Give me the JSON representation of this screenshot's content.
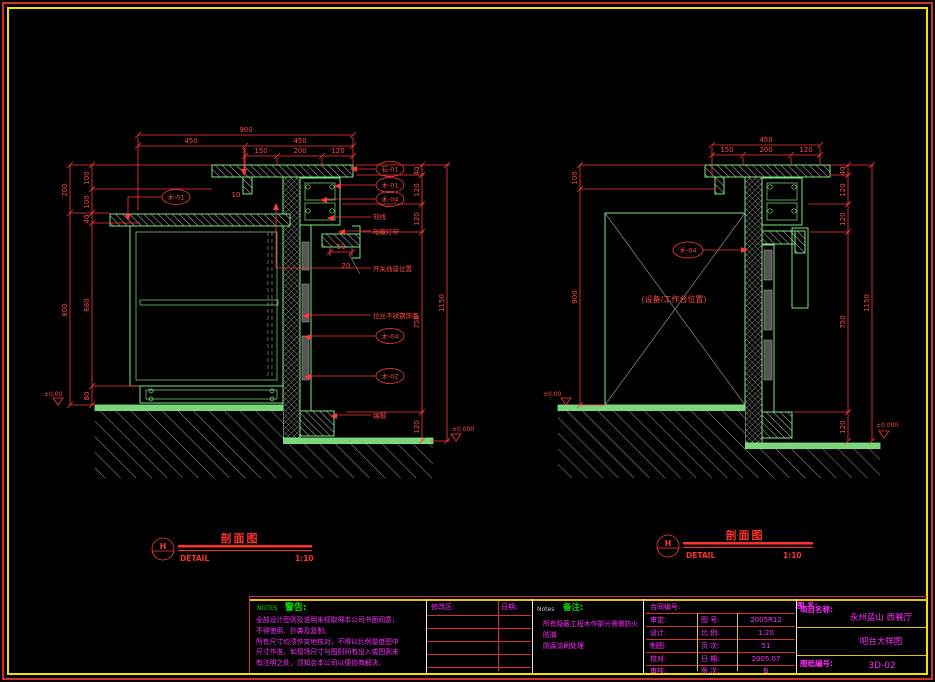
{
  "colors": {
    "line_green": "#7de57d",
    "dim_red": "#ff3838",
    "magenta": "#ff2bff",
    "note_green": "#00e000",
    "frame_yellow": "#f5e100",
    "frame_red": "#d03030"
  },
  "left_view": {
    "top_dims": {
      "total": "900",
      "seg_left": "450",
      "seg_right": "450",
      "s1": "150",
      "s2": "200",
      "s3": "120",
      "drop": "10"
    },
    "left_dims": {
      "a": "200",
      "b": "100",
      "c": "100",
      "d": "40",
      "e": "800",
      "f": "680",
      "g": "80",
      "level": "±0.00"
    },
    "right_dims": {
      "a": "40",
      "b": "120",
      "c": "120",
      "d": "750",
      "e": "120",
      "total": "1150",
      "level": "±0.000"
    },
    "misc_dims": {
      "a": "50",
      "b": "20"
    },
    "callouts": {
      "top": "木-01",
      "r1": "石-01",
      "r2": "木-01",
      "r3": "木-04",
      "m1": "木-04",
      "m2": "木-02"
    },
    "labels": {
      "l1": "刻线",
      "l2": "暗藏灯带",
      "l3": "开关插座位置",
      "l4": "拉丝不锈钢饰面",
      "l5": "踢脚"
    }
  },
  "right_view": {
    "top_dims": {
      "total": "450",
      "s1": "150",
      "s2": "200",
      "s3": "120"
    },
    "left_dims": {
      "a": "100",
      "b": "900",
      "level": "±0.00"
    },
    "right_dims": {
      "a": "40",
      "b": "120",
      "c": "120",
      "d": "750",
      "e": "120",
      "total": "1150",
      "level": "±0.000"
    },
    "callout": "木-04",
    "center_note": "(设备/工作台位置)"
  },
  "section_titles": {
    "left": {
      "mark": "H",
      "title": "剖面图",
      "caption": "DETAIL",
      "scale": "1:10"
    },
    "right": {
      "mark": "H",
      "title": "剖面图",
      "caption": "DETAIL",
      "scale": "1:10"
    }
  },
  "title_block": {
    "warning": {
      "tag": "NOTES",
      "heading": "警告:",
      "lines": [
        "全部设计图则及说明未经取得本公司书面同意，",
        "不得使用、抄袭及复制。",
        "所有尺寸均须作实地核对，不得以比例量度图中",
        "尺寸作准。如现场尺寸与图则间有出入或图则未",
        "有注明之处，须知会本公司以便协商解决。"
      ]
    },
    "revision": {
      "header": "修改区:",
      "date": "日期:"
    },
    "notes": {
      "tag": "Notes",
      "heading": "备注:",
      "lines": [
        "所有隐蔽工程木作部分需做防火防潮",
        "防腐涂刷处理"
      ]
    },
    "info": {
      "contract_label": "合同编号:",
      "rows": [
        {
          "role": "审定:",
          "key": "图 号:",
          "value": "2005R12"
        },
        {
          "role": "设计:",
          "key": "比 例:",
          "value": "1:20"
        },
        {
          "role": "制图:",
          "key": "页 次:",
          "value": "51"
        },
        {
          "role": "校对:",
          "key": "日 期:",
          "value": "2005.07"
        },
        {
          "role": "审核:",
          "key": "版 次:",
          "value": "B"
        }
      ]
    },
    "project": {
      "name_label": "项目名称:",
      "name": "永州蓝山 西餐厅",
      "drawing_label": "图 名:",
      "drawing": "吧台大样图",
      "number_label": "图纸编号:",
      "number": "3D-02"
    }
  }
}
